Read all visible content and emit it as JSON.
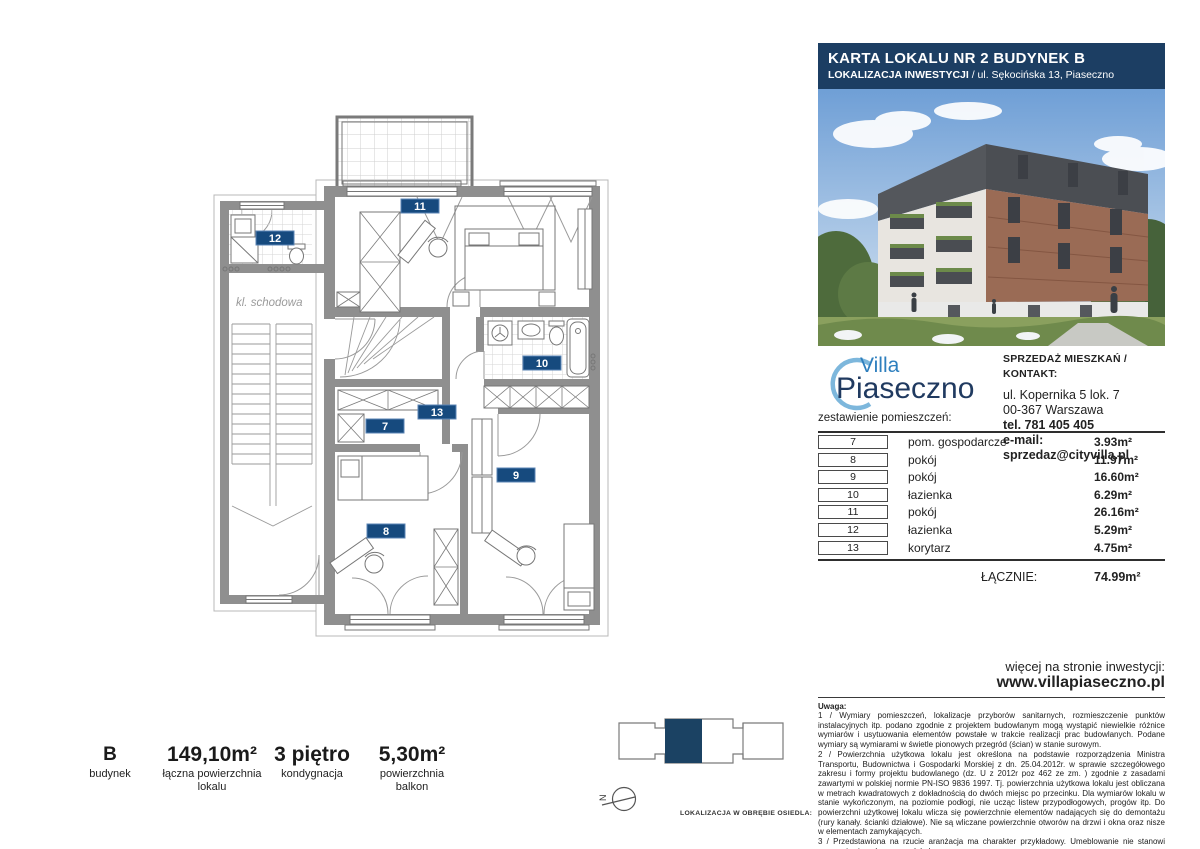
{
  "header": {
    "title": "KARTA LOKALU NR 2 BUDYNEK B",
    "location_label": "LOKALIZACJA INWESTYCJI",
    "location_value": " / ul. Sękocińska 13, Piaseczno"
  },
  "logo": {
    "line1": "Villa",
    "line2": "Piaseczno"
  },
  "contact": {
    "heading": "SPRZEDAŻ MIESZKAŃ / KONTAKT:",
    "address1": "ul. Kopernika 5 lok. 7",
    "address2": "00-367 Warszawa",
    "phone": "tel. 781 405 405",
    "email": "e-mail: sprzedaz@cityvilla.pl"
  },
  "rooms": {
    "heading": "zestawienie pomieszczeń:",
    "items": [
      {
        "no": "7",
        "name": "pom. gospodarcze",
        "area": "3.93m²"
      },
      {
        "no": "8",
        "name": "pokój",
        "area": "11.97m²"
      },
      {
        "no": "9",
        "name": "pokój",
        "area": "16.60m²"
      },
      {
        "no": "10",
        "name": "łazienka",
        "area": "6.29m²"
      },
      {
        "no": "11",
        "name": "pokój",
        "area": "26.16m²"
      },
      {
        "no": "12",
        "name": "łazienka",
        "area": "5.29m²"
      },
      {
        "no": "13",
        "name": "korytarz",
        "area": "4.75m²"
      }
    ],
    "total_label": "ŁĄCZNIE:",
    "total_area": "74.99m²"
  },
  "website": {
    "line1": "więcej na stronie inwestycji:",
    "line2": "www.villapiaseczno.pl"
  },
  "notes": {
    "heading": "Uwaga:",
    "body": "1 / Wymiary pomieszczeń, lokalizacje przyborów sanitarnych, rozmieszczenie punktów instalacyjnych itp. podano zgodnie z projektem budowlanym mogą wystąpić niewielkie różnice wymiarów i usytuowania elementów powstałe w trakcie realizacji prac budowlanych. Podane wymiary są wymiarami w świetle pionowych przegród (ścian) w stanie surowym.\n2 / Powierzchnia użytkowa lokalu jest określona na podstawie rozporządzenia Ministra Transportu, Budownictwa i Gospodarki Morskiej z dn. 25.04.2012r. w sprawie szczegółowego zakresu i formy projektu budowlanego (dz. U z 2012r poz 462 ze zm. ) zgodnie z zasadami zawartymi w polskiej normie PN-ISO 9836 1997. Tj. powierzchnia użytkowa lokalu jest obliczana w metrach kwadratowych z dokładnością do dwóch miejsc po przecinku. Dla wymiarów lokalu w stanie wykończonym, na poziomie podłogi, nie ucząc listew przypodłogowych, progów itp. Do powierzchni użytkowej lokalu wlicza się powierzchnie elementów nadających się do demontażu (rury kanały. ścianki działowe). Nie są wliczane powierzchnie otworów na drzwi i okna oraz nisze w elementach zamykających.\n3 / Przedstawiona na rzucie aranżacja ma charakter przykładowy. Umeblowanie nie stanowi wyposażenia nabywanego lokalu."
  },
  "stats": [
    {
      "value": "B",
      "label": "budynek"
    },
    {
      "value": "149,10m²",
      "label": "łączna powierzchnia lokalu"
    },
    {
      "value": "3 piętro",
      "label": "kondygnacja"
    },
    {
      "value": "5,30m²",
      "label": "powierzchnia balkon"
    }
  ],
  "plan": {
    "stairwell_label": "kl. schodowa",
    "labels": {
      "r7": "7",
      "r8": "8",
      "r9": "9",
      "r10": "10",
      "r11": "11",
      "r12": "12",
      "r13": "13"
    }
  },
  "estate": {
    "caption": "LOKALIZACJA W OBRĘBIE OSIEDLA:",
    "north_label": "N"
  },
  "colors": {
    "header_navy": "#1c3e63",
    "label_navy": "#164a7e",
    "estate_navy": "#1b4263",
    "logo_blue": "#2e7fbe",
    "logo_dark": "#203a60",
    "logo_arc": "#7db7dc",
    "wall_gray": "#8f8f8f",
    "brick": "#9a6b55"
  }
}
